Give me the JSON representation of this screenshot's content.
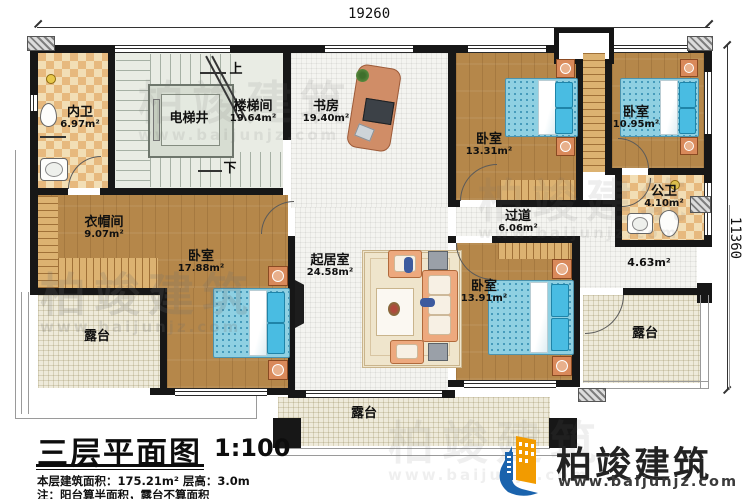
{
  "dimensions": {
    "width_mm": "19260",
    "height_mm": "11360"
  },
  "rooms": {
    "neiwei": {
      "name": "内卫",
      "area": "6.97m²"
    },
    "dianti": {
      "name": "电梯井"
    },
    "loutijian": {
      "name": "楼梯间",
      "area": "19.64m²"
    },
    "shufang": {
      "name": "书房",
      "area": "19.40m²"
    },
    "woshi1": {
      "name": "卧室",
      "area": "13.31m²"
    },
    "woshi2": {
      "name": "卧室",
      "area": "10.95m²"
    },
    "gongwei": {
      "name": "公卫",
      "area": "4.10m²"
    },
    "guodao": {
      "name": "过道",
      "area": "6.06m²"
    },
    "yimaojian": {
      "name": "衣帽间",
      "area": "9.07m²"
    },
    "woshi3": {
      "name": "卧室",
      "area": "17.88m²"
    },
    "qijushi": {
      "name": "起居室",
      "area": "24.58m²"
    },
    "woshi4": {
      "name": "卧室",
      "area": "13.91m²"
    },
    "balcony": {
      "area": "4.63m²"
    },
    "terrace_left": {
      "name": "露台"
    },
    "terrace_right": {
      "name": "露台"
    },
    "terrace_bottom": {
      "name": "露台"
    }
  },
  "stairs": {
    "up": "上",
    "down": "下"
  },
  "title_block": {
    "title": "三层平面图",
    "scale": "1:100",
    "area_line": "本层建筑面积：175.21m²  层高：3.0m",
    "note_line": "注：阳台算半面积，露台不算面积"
  },
  "logo": {
    "name": "柏竣建筑",
    "website": "www.baijunjz.com"
  },
  "watermark": {
    "name": "柏竣建筑",
    "website": "www.baijunjz.com"
  },
  "colors": {
    "wall": "#171717",
    "wood": "#b5874a",
    "tile": "#e7b97e",
    "terrace": "#eeeada",
    "bed": "#8fd0e2",
    "logo_blue": "#1a63ad",
    "logo_orange": "#f29b00"
  }
}
